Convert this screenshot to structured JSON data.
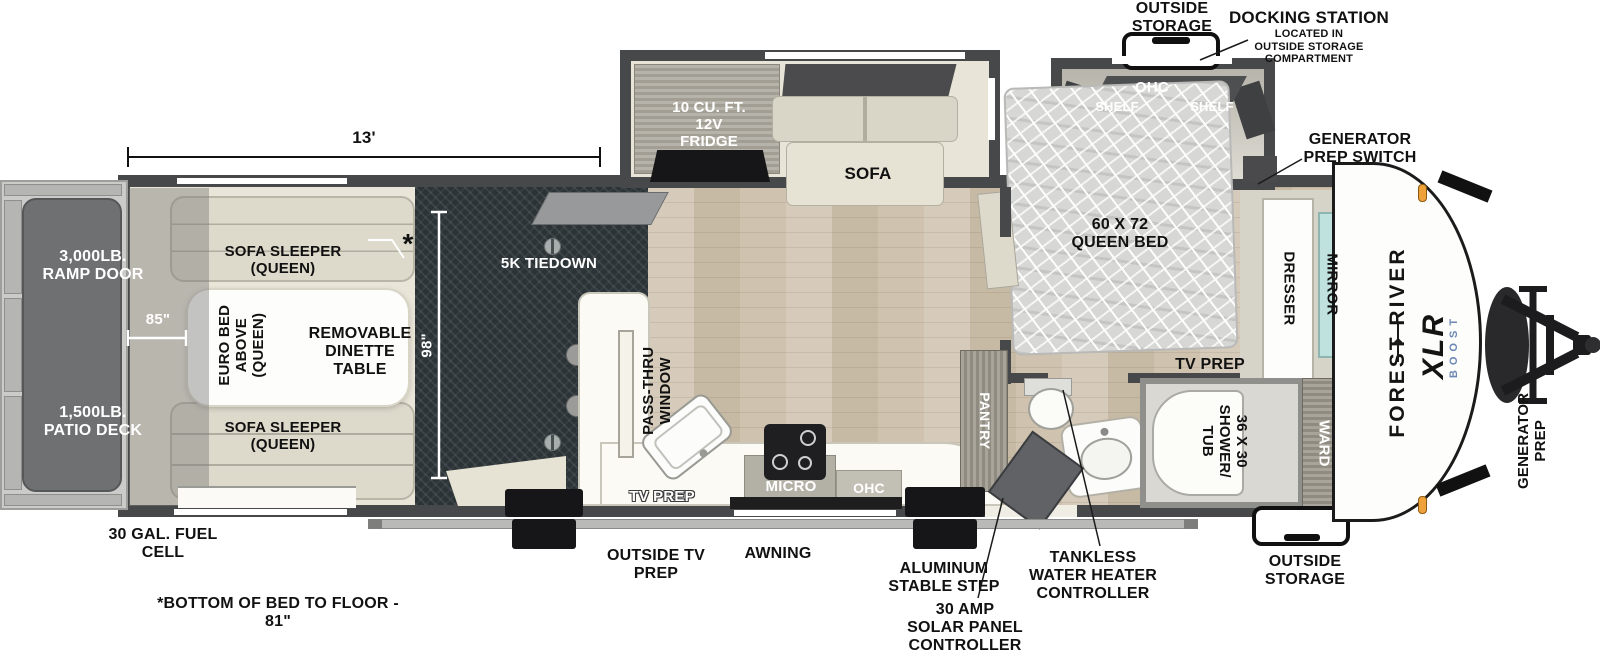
{
  "callouts": {
    "outside_storage_top": "OUTSIDE\nSTORAGE",
    "docking_title": "DOCKING STATION",
    "docking_sub": "LOCATED IN\nOUTSIDE STORAGE\nCOMPARTMENT",
    "generator_prep_switch": "GENERATOR\nPREP SWITCH",
    "tankless": "TANKLESS\nWATER HEATER\nCONTROLLER",
    "solar": "30 AMP\nSOLAR PANEL\nCONTROLLER",
    "stable_step": "ALUMINUM\nSTABLE STEP",
    "awning": "AWNING",
    "outside_tv_prep": "OUTSIDE TV\nPREP",
    "fuel_cell": "30 GAL. FUEL\nCELL",
    "outside_storage_bottom": "OUTSIDE\nSTORAGE",
    "generator_prep": "GENERATOR\nPREP",
    "bed_height_note": "*BOTTOM OF BED TO FLOOR - 81\""
  },
  "dimensions": {
    "length": "13'",
    "garage_depth": "98\"",
    "ramp_opening": "85\"",
    "asterisk": "*"
  },
  "garage_area": {
    "tiedown": "5K TIEDOWN",
    "ramp_door": "3,000LB.\nRAMP DOOR",
    "patio_deck": "1,500LB.\nPATIO DECK",
    "sofa_sleeper_top": "SOFA SLEEPER\n(QUEEN)",
    "sofa_sleeper_bottom": "SOFA SLEEPER\n(QUEEN)",
    "euro_bed": "EURO BED\nABOVE\n(QUEEN)",
    "dinette": "REMOVABLE\nDINETTE\nTABLE"
  },
  "kitchen": {
    "fridge": "10 CU. FT.\n12V\nFRIDGE",
    "sofa": "SOFA",
    "pass_thru": "PASS-THRU\nWINDOW",
    "micro": "MICRO",
    "ohc": "OHC",
    "tv_prep": "TV PREP",
    "pantry": "PANTRY"
  },
  "bedroom": {
    "queen_bed": "60 X 72\nQUEEN BED",
    "ohc": "OHC",
    "shelf_left": "SHELF",
    "shelf_right": "SHELF",
    "dresser": "DRESSER",
    "mirror": "MIRROR",
    "tv_prep": "TV PREP"
  },
  "bathroom": {
    "shower_tub": "36 X 30\nSHOWER/\nTUB",
    "ward": "WARD"
  },
  "brand": {
    "make": "FOREST RIVER",
    "model": "XLR",
    "trim": "BOOST"
  },
  "colors": {
    "wall": "#47484a",
    "garage_floor": "#2b3336",
    "wood_floor": "#cfc3af",
    "beige_floor": "#e9e5d8",
    "mirror_teal": "#bfe2de",
    "clearance_orange": "#f0a23a",
    "boost_blue": "#6c87b4",
    "deck_gray": "#6f7072"
  }
}
